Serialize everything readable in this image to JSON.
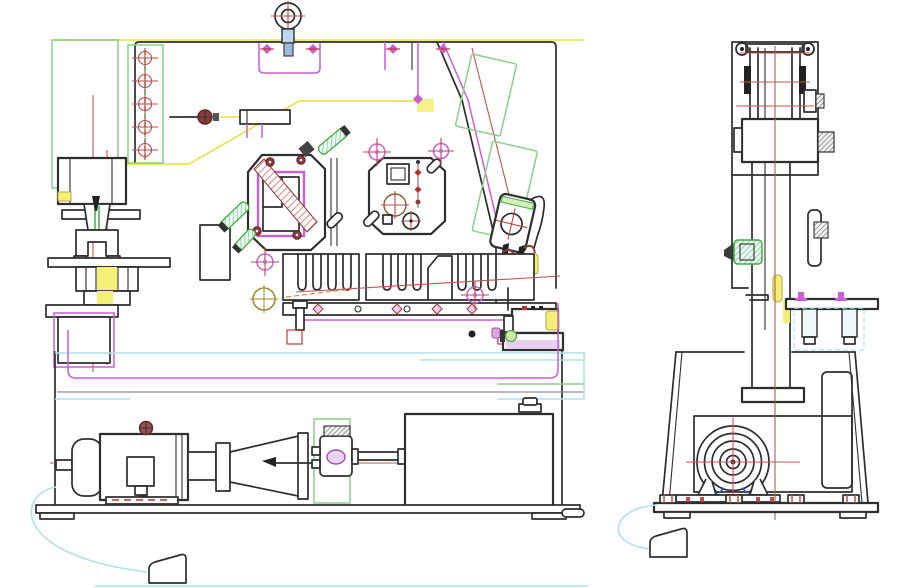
{
  "document": {
    "type": "CAD general-assembly drawing (2 orthographic views)",
    "subject": "Hydraulic ironworker punching and shearing machine",
    "background_color": "#ffffff",
    "visible_text": "none - drawing contains no dimensions, labels or annotations",
    "palette": {
      "outline": "#2e2e2e",
      "magenta_layer": "#c95fd0",
      "light_green_layer": "#8bcf8b",
      "dark_green": "#3fae3f",
      "red_centerline": "#c05555",
      "dark_red_hardware": "#8e3a3a",
      "yellow_highlight": "#f3ef77",
      "cyan_layer": "#aee3e6",
      "lavender_fill": "#e9d0f0",
      "olive": "#9f8c2e",
      "blue_accent": "#3b51c9",
      "gray_line": "#8f8f8f"
    }
  },
  "views": [
    {
      "id": "front-view",
      "title": "Front elevation - ironworker general assembly",
      "components": [
        {
          "id": "eyebolt-lifting-ring",
          "label": "Lifting eye bolt with red crosshair"
        },
        {
          "id": "lifting-bracket",
          "label": "Magenta lifting bracket with diamond bolts"
        },
        {
          "id": "guide-strip",
          "label": "Green guide strip with five cross-haired bolt holes"
        },
        {
          "id": "adjuster-rod",
          "label": "Adjuster rod with round knob"
        },
        {
          "id": "punch-ram",
          "label": "Punch ram head"
        },
        {
          "id": "punch-stripper",
          "label": "Punch stripper bracket"
        },
        {
          "id": "die-block",
          "label": "Yellow die block stack on bolster"
        },
        {
          "id": "bolster-pedestal",
          "label": "Bolster pedestal with magenta outline"
        },
        {
          "id": "spacer-block",
          "label": "Spacer block"
        },
        {
          "id": "shear-blade-plate",
          "label": "Shear blade plate with hatched blade and magenta frame"
        },
        {
          "id": "tool-face-plate",
          "label": "Tool face plate with gauge holes"
        },
        {
          "id": "hydraulic-cylinder",
          "label": "Inclined hydraulic cylinder (green) with red axis"
        },
        {
          "id": "cylinder-clevis",
          "label": "Cylinder clevis joint with hook and yellow pads"
        },
        {
          "id": "slotted-die-rail",
          "label": "Slotted die rail (comb plates)"
        },
        {
          "id": "clamp-rail",
          "label": "Clamp rail with diamond bolts and magenta strip"
        },
        {
          "id": "valve-block",
          "label": "Hydraulic valve block with yellow and green fittings"
        },
        {
          "id": "frame-lines",
          "label": "Lower frame: cyan / magenta / gray panel lines"
        },
        {
          "id": "electric-motor",
          "label": "Electric motor with terminal box"
        },
        {
          "id": "coupling-bell",
          "label": "Motor-to-pump coupling bell"
        },
        {
          "id": "gear-pump",
          "label": "Gear pump with lavender port"
        },
        {
          "id": "suction-pipe",
          "label": "Suction pipe to tank"
        },
        {
          "id": "oil-tank",
          "label": "Hydraulic oil tank with filler cap"
        },
        {
          "id": "base-rail",
          "label": "Base rail with machine feet"
        },
        {
          "id": "foot-pedal-front",
          "label": "Foot pedal with cyan cable"
        }
      ]
    },
    {
      "id": "side-view",
      "title": "Right side elevation - cylinder column and drive housing",
      "components": [
        {
          "id": "guide-frame",
          "label": "Top guide frame"
        },
        {
          "id": "cylinder-assembly",
          "label": "Vertical cylinder with ear rings and red centerlines"
        },
        {
          "id": "lock-nut-stack",
          "label": "Hex lock nuts (hatched)"
        },
        {
          "id": "piston-column",
          "label": "Piston column with slide plate"
        },
        {
          "id": "grease-fitting",
          "label": "Green grease fitting"
        },
        {
          "id": "stroke-indicator",
          "label": "Yellow stroke indicator pill"
        },
        {
          "id": "work-table",
          "label": "Work table with magenta bolts and hanging studs"
        },
        {
          "id": "housing-frame",
          "label": "Trapezoidal drive housing"
        },
        {
          "id": "access-panel",
          "label": "Rear access panel"
        },
        {
          "id": "motor-end-view",
          "label": "Motor end view - concentric circles with crosshair"
        },
        {
          "id": "motor-mount",
          "label": "Motor foot mount with red anchor marks"
        },
        {
          "id": "base-plate",
          "label": "Base plate with anchor pads and feet"
        },
        {
          "id": "foot-pedal-side",
          "label": "Foot pedal with cyan cable"
        }
      ]
    }
  ]
}
